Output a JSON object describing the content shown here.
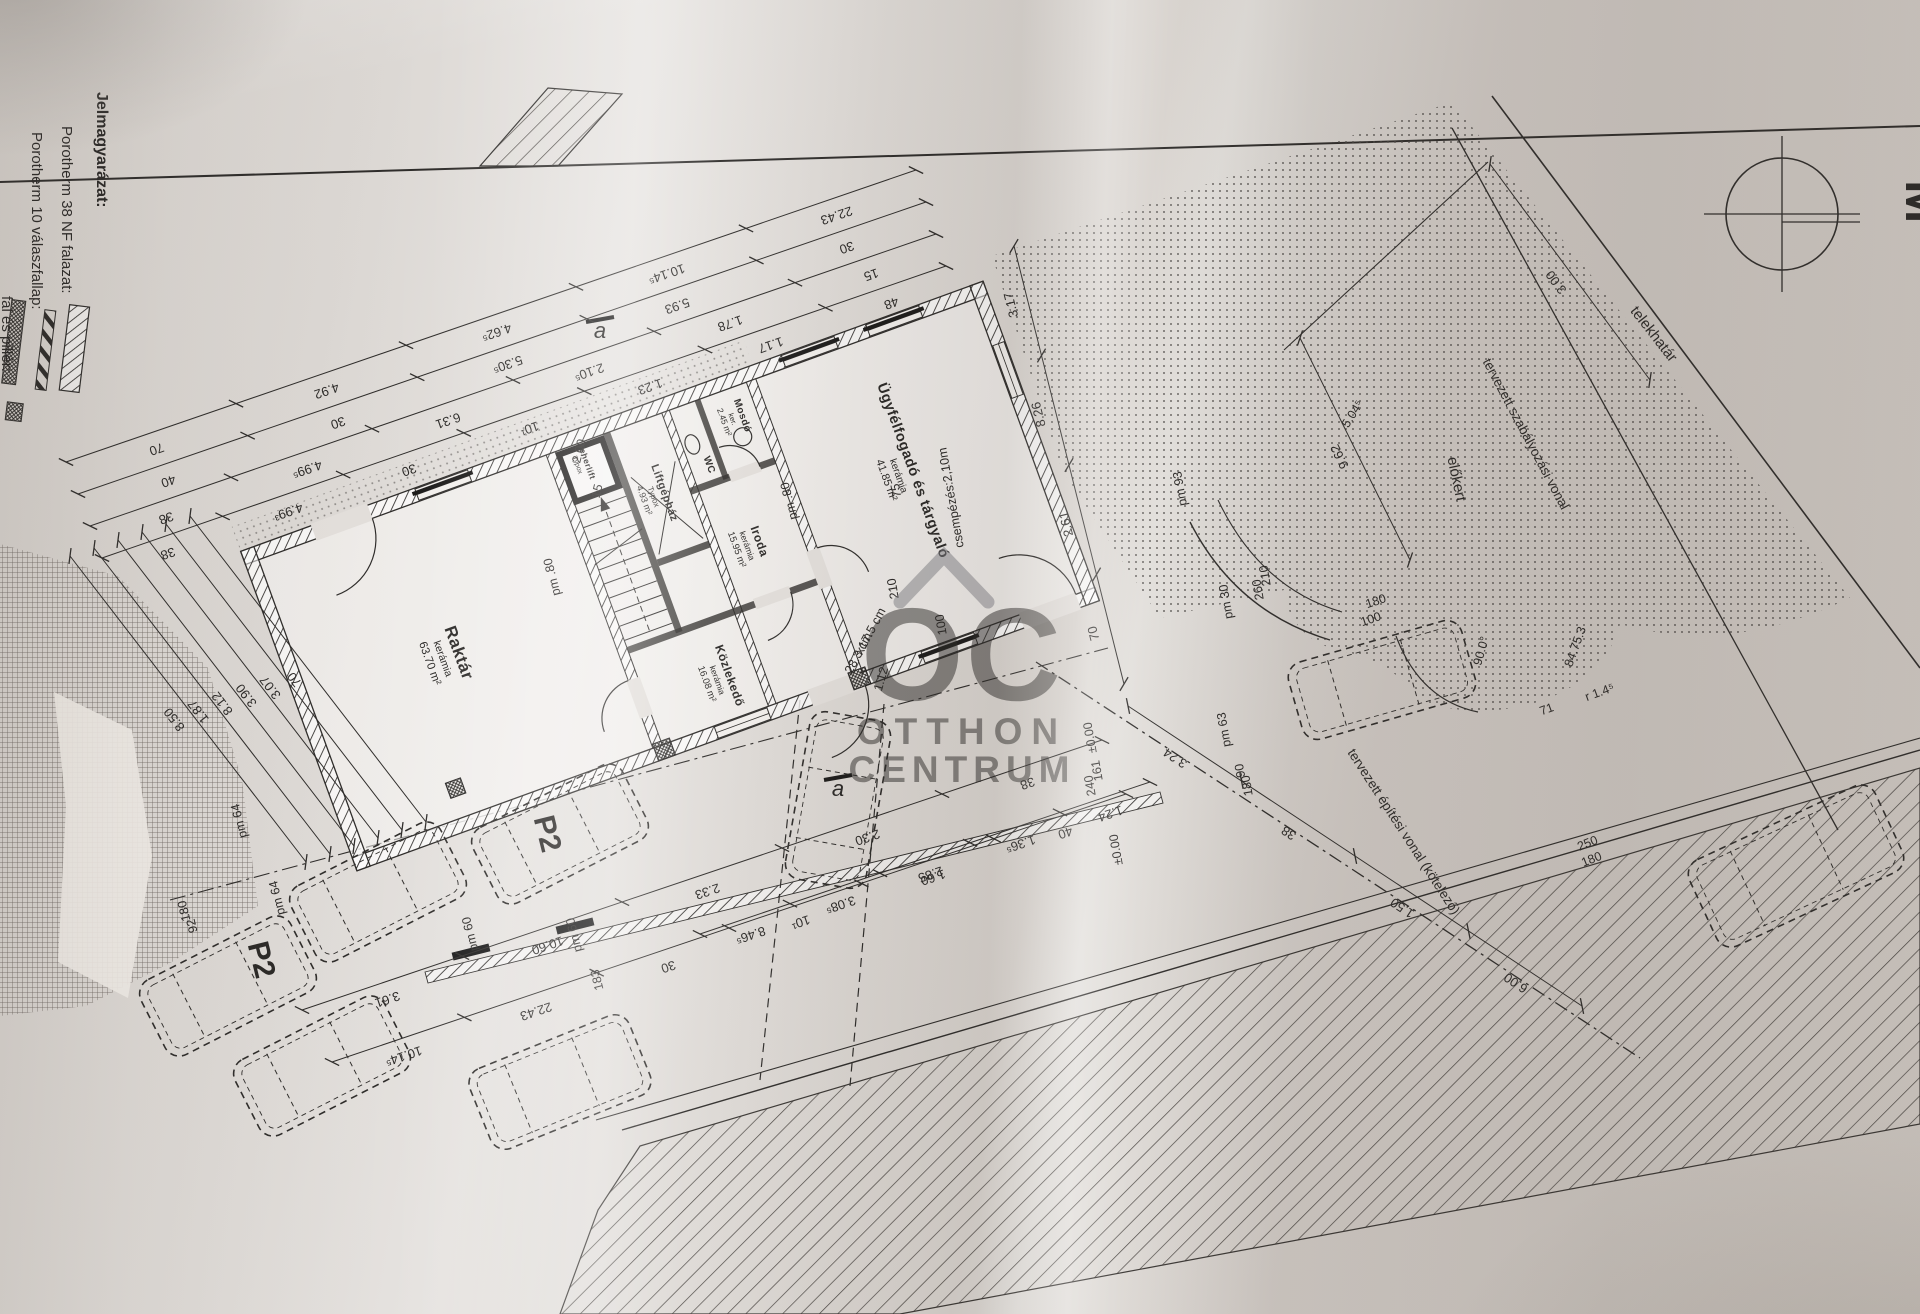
{
  "legend": {
    "title": "Jelmagyarázat:",
    "items": [
      {
        "label": "Porotherm 38 NF falazat:"
      },
      {
        "label": "Porotherm 10 válaszfallap:"
      },
      {
        "label": "fal és pillér:"
      }
    ]
  },
  "watermark": {
    "logo": "OC",
    "line1": "OTTHON",
    "line2": "CENTRUM"
  },
  "compass": {
    "scale_label": "M"
  },
  "site": {
    "telekhatar": "telekhatár",
    "szabalyozasi_vonal": "tervezett szabályozási vonal",
    "epitesi_vonal": "tervezett építési vonal (kötelező)",
    "elokert": "előkert"
  },
  "rooms": [
    {
      "name": "Raktár",
      "finish": "kerámia",
      "area": "63.70 m²"
    },
    {
      "name": "Közlekedő",
      "finish": "kerámia",
      "area": "16.08 m²"
    },
    {
      "name": "Iroda",
      "finish": "kerámia",
      "area": "15.95 m²"
    },
    {
      "name": "Ügyfélfogadó és tárgyaló",
      "finish": "kerámia",
      "area": "41.85 m²"
    },
    {
      "name": "Mosdó",
      "finish": "ker.",
      "area": "2.45 m²"
    },
    {
      "name": "WC",
      "finish": "",
      "area": ""
    },
    {
      "name": "Liftgépház",
      "finish": "Typox",
      "area": "4.93 m²"
    },
    {
      "name": "Teherlift",
      "finish": "Typox",
      "area": ""
    }
  ],
  "parking": {
    "stall_labels": [
      "P2",
      "P2"
    ]
  },
  "chains": [
    {
      "x1": 66,
      "y1": 462,
      "x2": 916,
      "y2": 170,
      "vals": [
        "70",
        "4.92",
        "4.62⁵",
        "10.14⁵",
        "22.43"
      ]
    },
    {
      "x1": 78,
      "y1": 494,
      "x2": 926,
      "y2": 202,
      "vals": [
        "40",
        "30",
        "5.30⁵",
        "5.93",
        "30"
      ]
    },
    {
      "x1": 90,
      "y1": 526,
      "x2": 936,
      "y2": 234,
      "vals": [
        "38",
        "4.99⁵",
        "6.31",
        "2.10⁵",
        "1.78",
        "15"
      ]
    },
    {
      "x1": 102,
      "y1": 558,
      "x2": 946,
      "y2": 266,
      "vals": [
        "38",
        "4.99³",
        "30",
        "10¹",
        "1.23",
        "1.17",
        "48"
      ]
    },
    {
      "x1": 70,
      "y1": 556,
      "x2": 306,
      "y2": 862,
      "vals": [
        "8.50"
      ]
    },
    {
      "x1": 94,
      "y1": 548,
      "x2": 330,
      "y2": 854,
      "vals": [
        "1.87"
      ]
    },
    {
      "x1": 118,
      "y1": 540,
      "x2": 354,
      "y2": 846,
      "vals": [
        "8.12"
      ]
    },
    {
      "x1": 142,
      "y1": 532,
      "x2": 378,
      "y2": 838,
      "vals": [
        "3.90"
      ]
    },
    {
      "x1": 166,
      "y1": 524,
      "x2": 402,
      "y2": 830,
      "vals": [
        "3.07"
      ]
    },
    {
      "x1": 190,
      "y1": 516,
      "x2": 426,
      "y2": 822,
      "vals": [
        "70"
      ]
    },
    {
      "x1": 302,
      "y1": 1010,
      "x2": 1102,
      "y2": 740,
      "vals": [
        "3.61",
        "10.60",
        "2.33",
        "2.30",
        "38"
      ]
    },
    {
      "x1": 332,
      "y1": 1062,
      "x2": 1126,
      "y2": 794,
      "vals": [
        "10.14⁵",
        "22.43",
        "30",
        "10¹",
        "1.60",
        "40"
      ]
    },
    {
      "x1": 700,
      "y1": 934,
      "x2": 1150,
      "y2": 782,
      "vals": [
        "8.46⁵",
        "3.08⁵",
        "2.85",
        "1.36⁵",
        "1.24"
      ]
    },
    {
      "x1": 1014,
      "y1": 246,
      "x2": 1124,
      "y2": 684,
      "vals": [
        "3.17",
        "8.26",
        "2.61",
        "70"
      ]
    },
    {
      "x1": 1128,
      "y1": 706,
      "x2": 1582,
      "y2": 1006,
      "vals": [
        "3.24",
        "38",
        "1.50",
        "6.00"
      ]
    },
    {
      "x1": 1490,
      "y1": 164,
      "x2": 1650,
      "y2": 380,
      "vals": [
        "3.00"
      ]
    },
    {
      "x1": 1300,
      "y1": 338,
      "x2": 1410,
      "y2": 560,
      "vals": [
        "9.62"
      ]
    }
  ],
  "small_dims": [
    {
      "t": "pm .80",
      "x": 556,
      "y": 576,
      "r": -104
    },
    {
      "t": "pm .80",
      "x": 793,
      "y": 500,
      "r": -104
    },
    {
      "t": "pm 64",
      "x": 243,
      "y": 820,
      "r": -104
    },
    {
      "t": "pm 64",
      "x": 281,
      "y": 897,
      "r": -104
    },
    {
      "t": "180",
      "x": 188,
      "y": 910,
      "r": -104
    },
    {
      "t": "92",
      "x": 196,
      "y": 925,
      "r": -104
    },
    {
      "t": "pm 60",
      "x": 474,
      "y": 933,
      "r": -104
    },
    {
      "t": "pm 60",
      "x": 578,
      "y": 934,
      "r": -104
    },
    {
      "t": "183",
      "x": 601,
      "y": 979,
      "r": -104
    },
    {
      "t": "pm 93",
      "x": 1184,
      "y": 488,
      "r": -100
    },
    {
      "t": "pm 30",
      "x": 1230,
      "y": 601,
      "r": -100
    },
    {
      "t": "pm 63",
      "x": 1228,
      "y": 729,
      "r": -100
    },
    {
      "t": "90",
      "x": 1244,
      "y": 770,
      "r": -100
    },
    {
      "t": "180",
      "x": 1251,
      "y": 785,
      "r": -100
    },
    {
      "t": "210",
      "x": 1269,
      "y": 575,
      "r": -100
    },
    {
      "t": "260",
      "x": 1262,
      "y": 589,
      "r": -100
    },
    {
      "t": "100",
      "x": 945,
      "y": 624,
      "r": -100
    },
    {
      "t": "210",
      "x": 897,
      "y": 588,
      "r": -100
    },
    {
      "t": "75",
      "x": 900,
      "y": 490,
      "r": -100
    },
    {
      "t": "2.00",
      "x": 583,
      "y": 452,
      "r": -76
    },
    {
      "t": "15",
      "x": 601,
      "y": 492,
      "r": -76
    },
    {
      "t": "csempézés:2,10m",
      "x": 955,
      "y": 497,
      "r": -100
    },
    {
      "t": "x17.5 cm",
      "x": 874,
      "y": 633,
      "r": -62
    },
    {
      "t": "28.3 cm",
      "x": 862,
      "y": 655,
      "r": -62
    },
    {
      "t": "1.12",
      "x": 885,
      "y": 680,
      "r": -74
    },
    {
      "t": "±0.00",
      "x": 1094,
      "y": 737,
      "r": -100
    },
    {
      "t": "±0.00",
      "x": 1120,
      "y": 849,
      "r": -100
    },
    {
      "t": "161",
      "x": 1101,
      "y": 770,
      "r": -100
    },
    {
      "t": "240",
      "x": 1094,
      "y": 785,
      "r": -100
    },
    {
      "t": "180",
      "x": 1377,
      "y": 605,
      "r": -18
    },
    {
      "t": "100",
      "x": 1372,
      "y": 623,
      "r": -18
    },
    {
      "t": "250",
      "x": 1589,
      "y": 847,
      "r": -22
    },
    {
      "t": "180",
      "x": 1593,
      "y": 863,
      "r": -22
    },
    {
      "t": "90.0°",
      "x": 1485,
      "y": 652,
      "r": -74
    },
    {
      "t": "84.75.3",
      "x": 1579,
      "y": 648,
      "r": -70
    },
    {
      "t": "r 1.4⁵",
      "x": 1601,
      "y": 696,
      "r": -20
    },
    {
      "t": "71",
      "x": 1548,
      "y": 713,
      "r": -20
    },
    {
      "t": "5.04⁵",
      "x": 1356,
      "y": 416,
      "r": -58
    },
    {
      "t": "a",
      "x": 600,
      "y": 338,
      "r": 0,
      "fs": 22,
      "it": true
    },
    {
      "t": "a",
      "x": 838,
      "y": 796,
      "r": 0,
      "fs": 22,
      "it": true
    }
  ],
  "cars": [
    {
      "cx": 378,
      "cy": 892,
      "w": 168,
      "h": 84,
      "a": -27
    },
    {
      "cx": 560,
      "cy": 834,
      "w": 168,
      "h": 84,
      "a": -27
    },
    {
      "cx": 228,
      "cy": 986,
      "w": 168,
      "h": 84,
      "a": -27
    },
    {
      "cx": 322,
      "cy": 1066,
      "w": 168,
      "h": 84,
      "a": -27
    },
    {
      "cx": 560,
      "cy": 1082,
      "w": 172,
      "h": 86,
      "a": -22
    },
    {
      "cx": 1382,
      "cy": 680,
      "w": 180,
      "h": 80,
      "a": -16
    },
    {
      "cx": 1796,
      "cy": 866,
      "w": 205,
      "h": 95,
      "a": -25
    },
    {
      "cx": 838,
      "cy": 800,
      "w": 170,
      "h": 82,
      "a": -80
    }
  ]
}
